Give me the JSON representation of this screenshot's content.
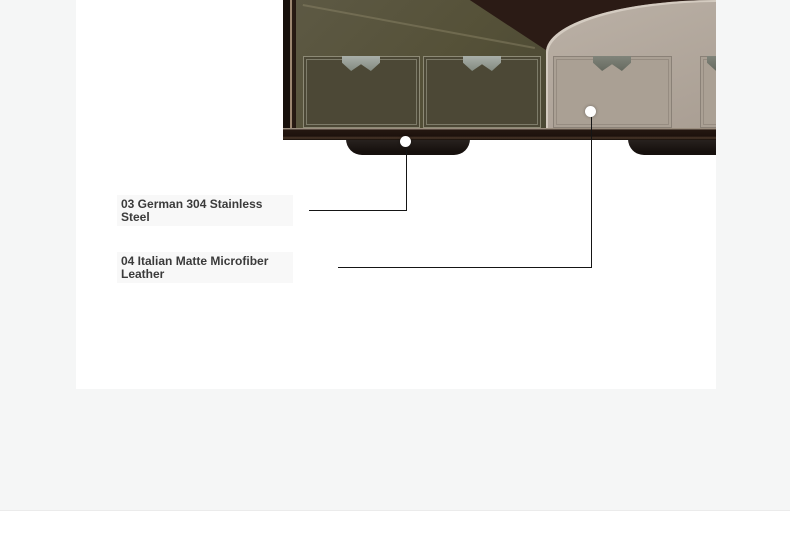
{
  "section": {
    "callouts": [
      {
        "label": "03 German 304 Stainless Steel"
      },
      {
        "label": "04 Italian Matte Microfiber Leather"
      }
    ]
  },
  "photo": {
    "description_markers": [
      "steel-foot-marker",
      "leather-panel-marker"
    ]
  },
  "colors": {
    "page_background": "#f5f6f6",
    "content_background": "#ffffff",
    "wood_dark": "#2b1b15",
    "olive_fabric": "#555138",
    "olive_drawer": "#4c4836",
    "taupe_fabric": "#b2a79c",
    "taupe_drawer": "#aaa094",
    "tab_gray_light": "#9aa09a",
    "tab_gray_dark": "#73776d",
    "callout_line": "#151515",
    "callout_text": "#3b3b3b",
    "label_background": "#f8f8f8"
  }
}
